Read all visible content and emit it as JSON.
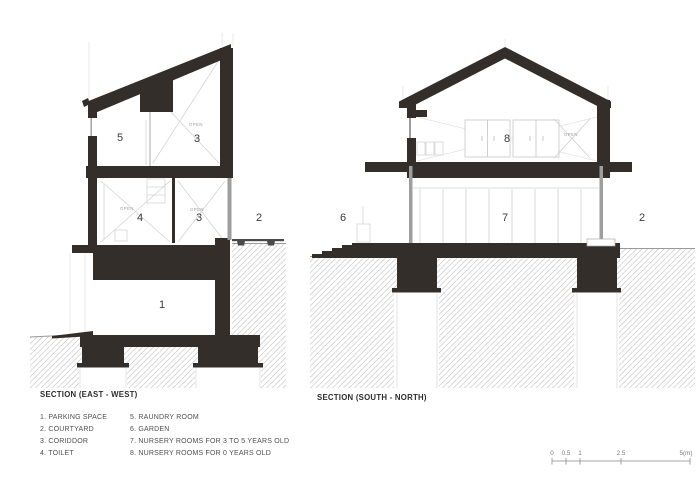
{
  "drawing": {
    "east_west": {
      "title": "SECTION (EAST - WEST)",
      "rooms": {
        "r5": "5",
        "r3_upper": "3",
        "r4": "4",
        "r3_mid": "3",
        "r2": "2",
        "r1": "1"
      },
      "open_label": "OPEN"
    },
    "south_north": {
      "title": "SECTION (SOUTH - NORTH)",
      "rooms": {
        "r6": "6",
        "r7": "7",
        "r8": "8",
        "r2": "2"
      },
      "open_label": "OPEN"
    }
  },
  "legend": {
    "col1": [
      "1. PARKING SPACE",
      "2. COURTYARD",
      "3. CORIDDOR",
      "4. TOILET"
    ],
    "col2": [
      "5. RAUNDRY ROOM",
      "6. GARDEN",
      "7. NURSERY ROOMS FOR 3 TO 5 YEARS OLD",
      "8. NURSERY ROOMS FOR 0 YEARS OLD"
    ]
  },
  "scale_bar": {
    "labels": [
      "0",
      "0.5",
      "1",
      "2.5",
      "5(m)"
    ]
  },
  "colors": {
    "background": "#ffffff",
    "ink": "#332e2a",
    "hatch_line": "#c9c9c9",
    "glass": "#9e9e9e",
    "detail_line": "#d2d2d2",
    "room_label": "#3a3a3a",
    "open_label": "#9c9c9c",
    "title": "#2d2d2d",
    "legend_text": "#4f4f4f",
    "scale": "#7a7a7a"
  }
}
